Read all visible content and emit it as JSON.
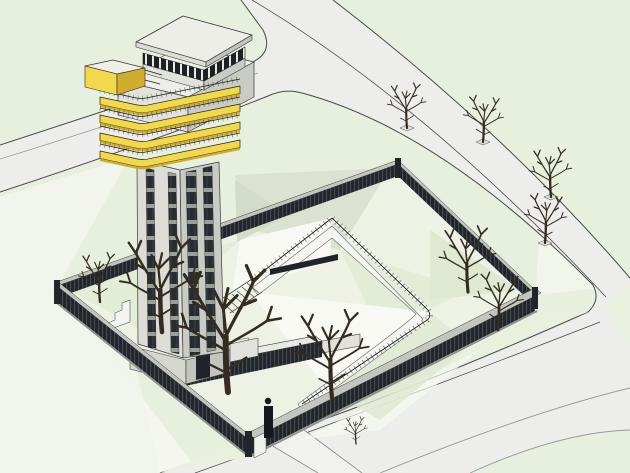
{
  "view": {
    "width": 630,
    "height": 473
  },
  "scene": {
    "type": "3d-architectural-model",
    "subject": "observation-tower-with-walled-compound",
    "style": "sketchup-perspective-render",
    "elements": [
      "observation-tower",
      "tower-cabin",
      "tower-head",
      "yellow-balcony-bands",
      "cantilever-balcony-box",
      "tower-shaft-window-strips",
      "tower-entrance",
      "perimeter-fence",
      "entrance-gate",
      "courtyard",
      "courtyard-walkway-ramp",
      "walkway-stairs",
      "service-canopy",
      "road-north",
      "road-east",
      "road-south",
      "pedestrian-crossing",
      "street-trees",
      "courtyard-trees",
      "sapling"
    ],
    "counts": {
      "street_trees": 4,
      "courtyard_trees": 6,
      "saplings": 1,
      "balcony_bands": 4
    }
  },
  "palette": {
    "ground": "#e7efde",
    "groundLight": "#f2f5eb",
    "groundWhite": "#f7f9f2",
    "greenStrip": "#e9f0de",
    "courtyard": "#eef2e5",
    "facetGreen": "#e3ecd7",
    "facetGreen2": "#dfe9d2",
    "facetGray": "#dbe2d1",
    "facetDark": "#d3dbc9",
    "road": "#ededeb",
    "roadLineDark": "#4a4a4a",
    "roadLineGray": "#9a9a96",
    "crossing": "#f1f1ed",
    "wallLight": "#e0e2db",
    "wallMid": "#dcded6",
    "wallDark": "#c9ccc4",
    "wallShade": "#c2c5bd",
    "plinth": "#d5d7cf",
    "roofTop": "#eceee7",
    "white": "#f4f5f0",
    "windowDark": "#272c31",
    "cabinGlass": "#1d2124",
    "fenceDark": "#22262b",
    "fenceCap": "#c3c6be",
    "fenceBase": "#8f948c",
    "canopyCap": "#e9eae3",
    "yellow": "#f2d84b",
    "yellowDark": "#cfae2f",
    "railing": "#1b1b1b",
    "tree": "#352c21",
    "outline": "#333333"
  }
}
